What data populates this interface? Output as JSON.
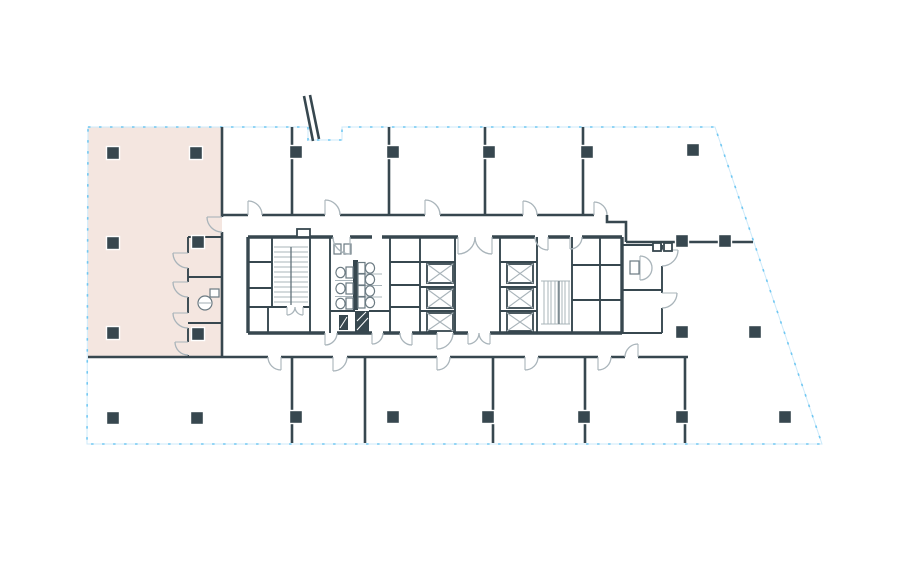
{
  "canvas": {
    "width": 900,
    "height": 570
  },
  "colors": {
    "background": "#ffffff",
    "wall": "#37474f",
    "mid": "#6b7a82",
    "light": "#a9b4ba",
    "boundary": "#6fc7f2",
    "boundarySoft": "#cdeafa",
    "suite": "#f4e6e0"
  },
  "boundary": {
    "description": "dashed perimeter / lease line with notch at top canopy and angled east facade",
    "points": [
      [
        88,
        127
      ],
      [
        308,
        127
      ],
      [
        308,
        140
      ],
      [
        342,
        140
      ],
      [
        342,
        127
      ],
      [
        715,
        127
      ],
      [
        822,
        444
      ],
      [
        87,
        444
      ]
    ]
  },
  "highlighted_suite": {
    "description": "highlighted corner suite, north-west",
    "points": [
      [
        88,
        127
      ],
      [
        222,
        127
      ],
      [
        222,
        357
      ],
      [
        88,
        357
      ]
    ]
  },
  "columns": [
    [
      113,
      153
    ],
    [
      196,
      153
    ],
    [
      296,
      152
    ],
    [
      393,
      152
    ],
    [
      489,
      152
    ],
    [
      587,
      152
    ],
    [
      693,
      150
    ],
    [
      113,
      243
    ],
    [
      198,
      242
    ],
    [
      682,
      241
    ],
    [
      725,
      241
    ],
    [
      113,
      333
    ],
    [
      198,
      334
    ],
    [
      682,
      332
    ],
    [
      755,
      332
    ],
    [
      113,
      418
    ],
    [
      197,
      418
    ],
    [
      296,
      417
    ],
    [
      393,
      417
    ],
    [
      488,
      417
    ],
    [
      584,
      417
    ],
    [
      682,
      417
    ],
    [
      785,
      417
    ]
  ],
  "summary": {
    "structural_columns": 23,
    "elevator_cars": 6,
    "stairwells": 2,
    "wc_fixtures": 7,
    "highlighted_suites": 1,
    "text_labels_visible": 0
  }
}
